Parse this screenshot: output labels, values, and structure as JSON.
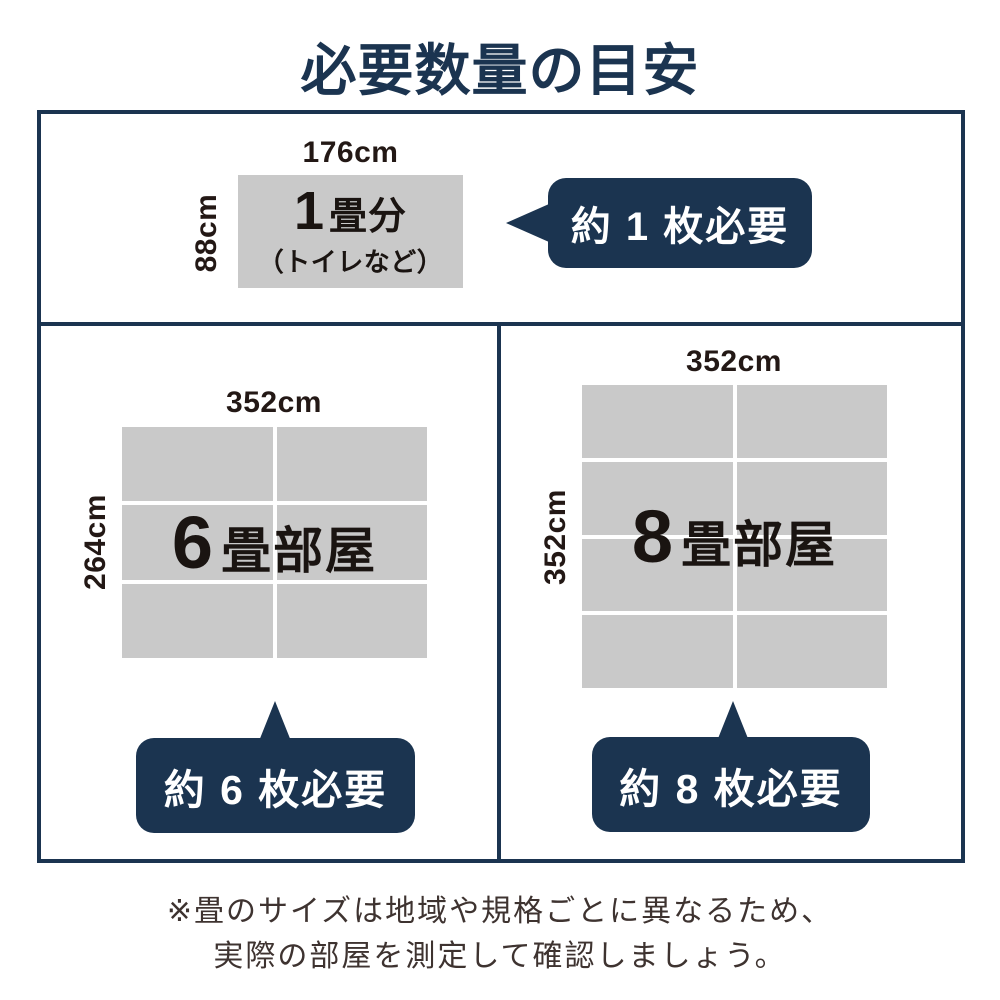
{
  "title": "必要数量の目安",
  "colors": {
    "navy": "#1b3450",
    "cell_gray": "#c9c9c9",
    "dimension_text": "#231815",
    "footer_text": "#3e3330",
    "bubble_text": "#ffffff"
  },
  "sections": {
    "one_tatami": {
      "width_label": "176cm",
      "height_label": "88cm",
      "number": "1",
      "unit_label": "畳分",
      "sub_label": "（トイレなど）",
      "bubble": "約 1 枚必要"
    },
    "six_tatami": {
      "width_label": "352cm",
      "height_label": "264cm",
      "number": "6",
      "unit_label": "畳部屋",
      "bubble": "約 6 枚必要",
      "grid": {
        "rows": 3,
        "cols": 2
      }
    },
    "eight_tatami": {
      "width_label": "352cm",
      "height_label": "352cm",
      "number": "8",
      "unit_label": "畳部屋",
      "bubble": "約 8 枚必要",
      "grid": {
        "rows": 4,
        "cols": 2
      }
    }
  },
  "footer": {
    "line1": "※畳のサイズは地域や規格ごとに異なるため、",
    "line2": "実際の部屋を測定して確認しましょう。"
  }
}
